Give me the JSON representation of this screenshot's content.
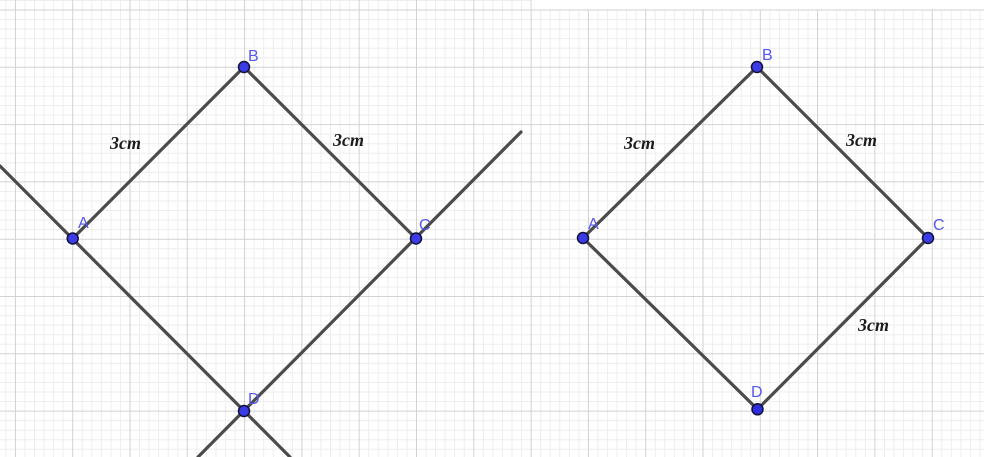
{
  "scene": {
    "width": 984,
    "height": 457,
    "background": "#ffffff",
    "grid": {
      "minor_spacing": 9.55,
      "major_spacing": 57.3,
      "offset_x": 15.4,
      "offset_y": 10,
      "minor_color": "#eeeeee",
      "major_color": "#d2d2d2",
      "line_width": 1
    },
    "paste_margin": {
      "comment_visible_as": "blank strip above right pasted figure",
      "x": 531.5,
      "y": 0,
      "width": 452.5,
      "height": 9.5,
      "color": "#ffffff"
    },
    "style": {
      "line_color": "#4b4b4b",
      "line_width": 3.2,
      "point_radius": 5.5,
      "point_stroke": "#10103c",
      "point_stroke_width": 1.5,
      "vertex_label_color": "#5656f0",
      "side_label_color": "#1c1c1c"
    },
    "figures": [
      {
        "id": "left-figure",
        "description": "rhombus ABCD with lines through A-D and C-D extended",
        "points": [
          {
            "label": "A",
            "x": 72.7,
            "y": 238.5,
            "fill": "#3c3ce6",
            "label_x": 78,
            "label_y": 228
          },
          {
            "label": "B",
            "x": 244,
            "y": 67,
            "fill": "#3c3ce6",
            "label_x": 248,
            "label_y": 61
          },
          {
            "label": "C",
            "x": 416,
            "y": 238.5,
            "fill": "#3c3ce6",
            "label_x": 419,
            "label_y": 230
          },
          {
            "label": "D",
            "x": 244,
            "y": 411,
            "fill": "#3c3ce6",
            "label_x": 248,
            "label_y": 404
          }
        ],
        "segments": [
          [
            "A",
            "B"
          ],
          [
            "B",
            "C"
          ]
        ],
        "lines": [
          {
            "x1": 0,
            "y1": 166,
            "x2": 290,
            "y2": 457
          },
          {
            "x1": 521,
            "y1": 132,
            "x2": 198,
            "y2": 457
          }
        ],
        "side_labels": [
          {
            "text": "3cm",
            "x": 110,
            "y": 149
          },
          {
            "text": "3cm",
            "x": 333,
            "y": 146
          }
        ]
      },
      {
        "id": "right-figure",
        "description": "rhombus ABCD drawn with segments only",
        "points": [
          {
            "label": "A",
            "x": 583,
            "y": 238,
            "fill": "#3c3ce6",
            "label_x": 588,
            "label_y": 229
          },
          {
            "label": "B",
            "x": 757,
            "y": 67,
            "fill": "#3c3ce6",
            "label_x": 762,
            "label_y": 60
          },
          {
            "label": "C",
            "x": 928,
            "y": 238,
            "fill": "#3c3ce6",
            "label_x": 933,
            "label_y": 230
          },
          {
            "label": "D",
            "x": 757.5,
            "y": 409.3,
            "fill": "#2e2ee0",
            "label_x": 751,
            "label_y": 397
          }
        ],
        "segments": [
          [
            "A",
            "B"
          ],
          [
            "B",
            "C"
          ],
          [
            "C",
            "D"
          ],
          [
            "D",
            "A"
          ]
        ],
        "lines": [],
        "side_labels": [
          {
            "text": "3cm",
            "x": 624,
            "y": 149
          },
          {
            "text": "3cm",
            "x": 846,
            "y": 146
          },
          {
            "text": "3cm",
            "x": 858,
            "y": 331
          }
        ]
      }
    ]
  }
}
